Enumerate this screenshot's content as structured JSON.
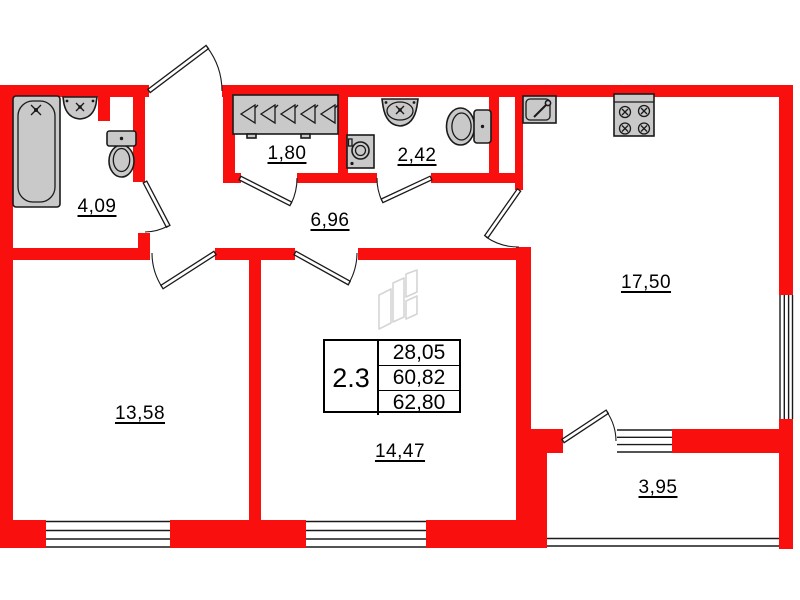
{
  "rooms": [
    {
      "name": "bathroom",
      "area": "4,09"
    },
    {
      "name": "dressing-room",
      "area": "1,80"
    },
    {
      "name": "water-closet",
      "area": "2,42"
    },
    {
      "name": "hallway",
      "area": "6,96"
    },
    {
      "name": "bedroom",
      "area": "13,58"
    },
    {
      "name": "living-room",
      "area": "14,47"
    },
    {
      "name": "kitchen",
      "area": "17,50"
    },
    {
      "name": "balcony",
      "area": "3,95"
    }
  ],
  "info_table": {
    "unit_number": "2.3",
    "rows": [
      "28,05",
      "60,82",
      "62,80"
    ]
  },
  "fixtures": [
    "bathtub-icon",
    "wall-sink-icon",
    "toilet-icon",
    "hanger-rail-icon",
    "washing-machine-icon",
    "vanity-sink-icon",
    "toilet-side-icon",
    "kitchen-sink-icon",
    "stove-icon"
  ],
  "colors": {
    "wall_red": "#f9100e",
    "line_black": "#1a1a1a",
    "fixture_gray": "#c9c9c9",
    "watermark_gray": "#d5d5d5"
  }
}
